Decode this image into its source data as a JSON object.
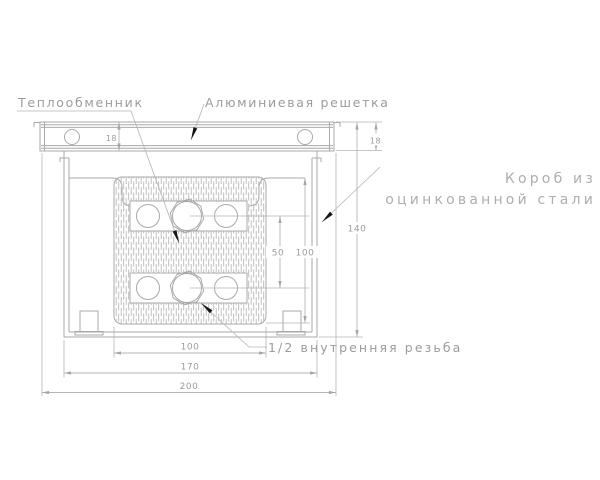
{
  "drawing": {
    "labels": {
      "heat_exchanger": "Теплообменник",
      "aluminum_grille": "Алюминиевая решетка",
      "steel_box_line1": "Короб из",
      "steel_box_line2": "оцинкованной стали",
      "thread": "1/2 внутренняя резьба"
    },
    "dimensions": {
      "grille_height_left": "18",
      "grille_height_right": "18",
      "total_height": "140",
      "interior_height": "100",
      "pipe_spacing": "50",
      "core_width": "100",
      "box_width": "170",
      "grille_width": "200"
    },
    "colors": {
      "line": "#a9a9a9",
      "line_thin": "#b5b5b5",
      "text": "#9c9c9c",
      "label_light": "#aeaeae",
      "arrow": "#161616",
      "background": "#ffffff"
    }
  }
}
